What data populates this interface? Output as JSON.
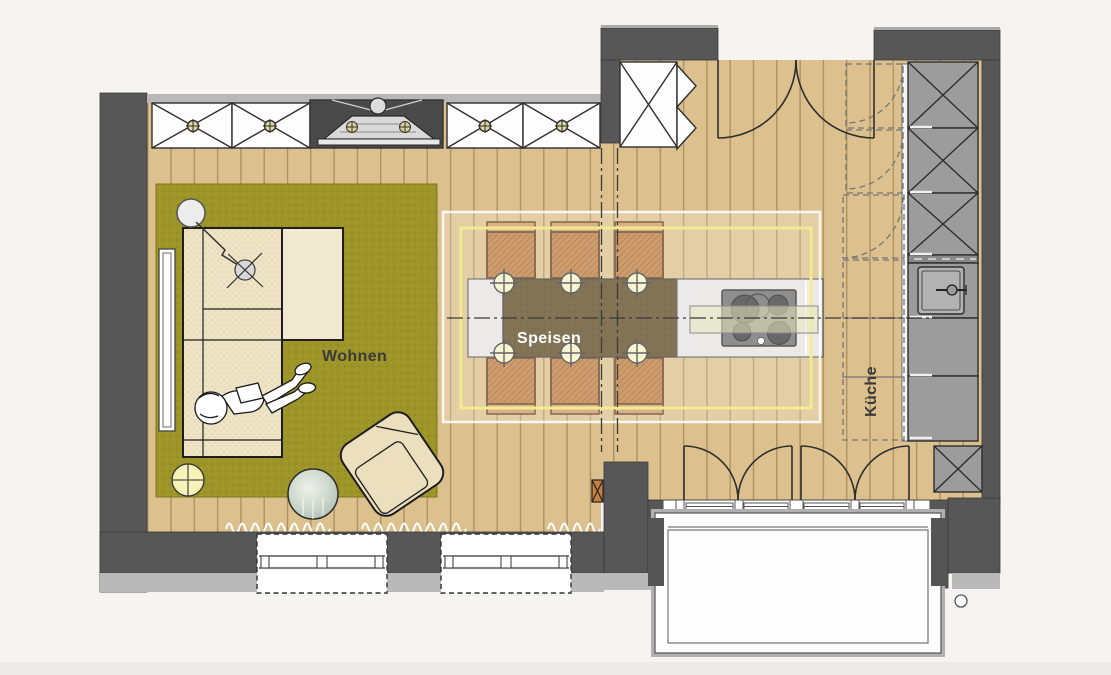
{
  "meta": {
    "title": "Wohnkueche Grundriss",
    "type": "floor-plan",
    "language": "de"
  },
  "rooms": [
    {
      "id": "wohnen",
      "label": "Wohnen"
    },
    {
      "id": "speisen",
      "label": "Speisen"
    },
    {
      "id": "kueche",
      "label": "Küche"
    }
  ],
  "legend": {
    "furniture": [
      "corner-sofa",
      "chaise",
      "reading-person",
      "armchair",
      "round-glass-table",
      "floor-lamp",
      "arc-lamp",
      "side-lamp",
      "rug",
      "radiator",
      "fireplace-stove",
      "wall-cabinets",
      "dining-table",
      "dining-chairs",
      "place-settings",
      "kitchen-island",
      "cooktop",
      "extractor-hood",
      "tall-cabinets",
      "kitchen-counter",
      "sink",
      "base-cabinet",
      "double-door",
      "french-doors",
      "windows",
      "curtains",
      "balcony"
    ],
    "counts": {
      "dining_chairs": 6,
      "place_settings": 6,
      "cooktop_burners": 4,
      "windows": 2,
      "french_door_leaves": 4
    }
  },
  "colors": {
    "background": "#f5f4f1",
    "wall": "#575757",
    "wall_light": "#b9b9b9",
    "floor": "#dcc18e",
    "floor_line": "#ae9162",
    "rug": "#9d9528",
    "sofa": "#eee3c4",
    "dining_table": "#604c26",
    "chair": "#c08143",
    "cabinet": "#9c9c9c",
    "accent_yellow": "#f3eb90",
    "label_dark": "#3b3b3b",
    "label_light": "#ffffff"
  }
}
